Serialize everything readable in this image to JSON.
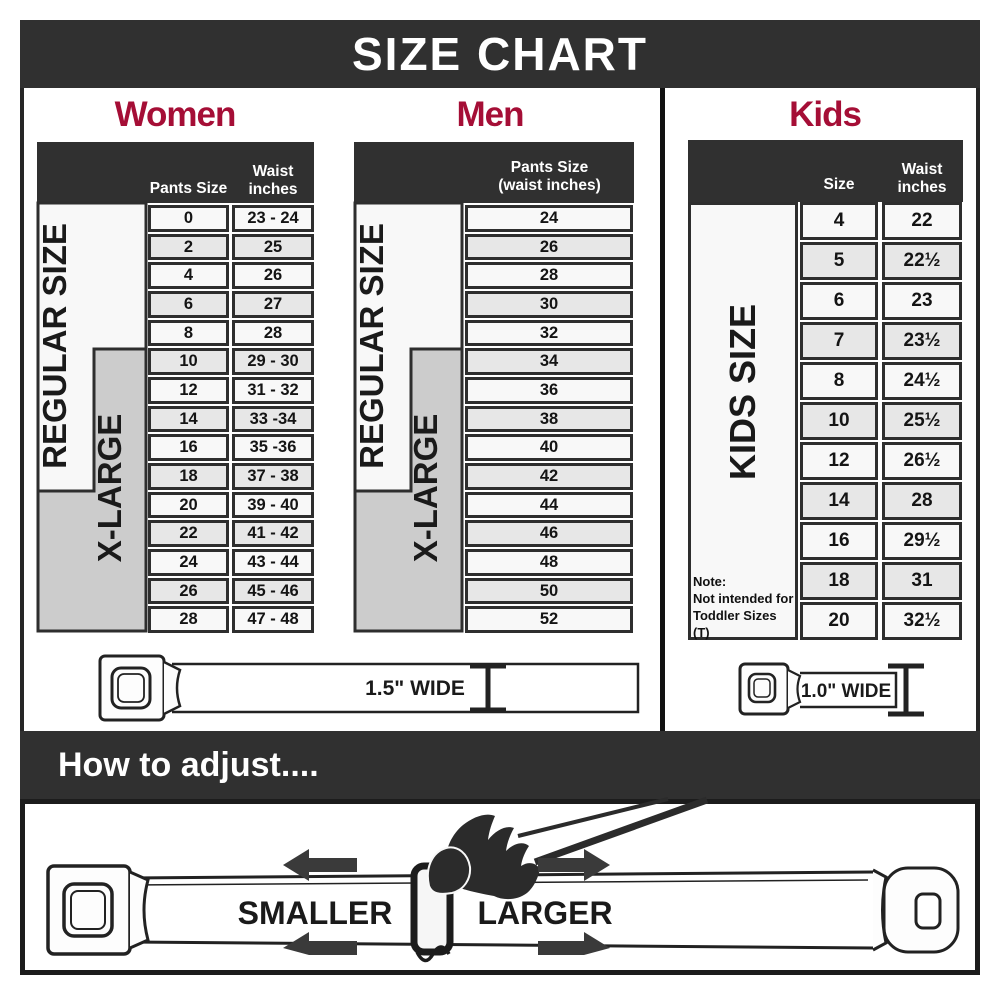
{
  "title": "SIZE CHART",
  "women": {
    "heading": "Women",
    "col1_header": "Pants Size",
    "col2_header_line1": "Waist",
    "col2_header_line2": "inches",
    "regular_label": "REGULAR SIZE",
    "xlarge_label": "X-LARGE",
    "rows": [
      [
        "0",
        "23 - 24"
      ],
      [
        "2",
        "25"
      ],
      [
        "4",
        "26"
      ],
      [
        "6",
        "27"
      ],
      [
        "8",
        "28"
      ],
      [
        "10",
        "29 - 30"
      ],
      [
        "12",
        "31 - 32"
      ],
      [
        "14",
        "33 -34"
      ],
      [
        "16",
        "35 -36"
      ],
      [
        "18",
        "37 - 38"
      ],
      [
        "20",
        "39 - 40"
      ],
      [
        "22",
        "41 - 42"
      ],
      [
        "24",
        "43 - 44"
      ],
      [
        "26",
        "45 - 46"
      ],
      [
        "28",
        "47 - 48"
      ]
    ],
    "belt_label": "1.5\" WIDE"
  },
  "men": {
    "heading": "Men",
    "header_line1": "Pants Size",
    "header_line2": "(waist inches)",
    "regular_label": "REGULAR SIZE",
    "xlarge_label": "X-LARGE",
    "sizes": [
      "24",
      "26",
      "28",
      "30",
      "32",
      "34",
      "36",
      "38",
      "40",
      "42",
      "44",
      "46",
      "48",
      "50",
      "52"
    ]
  },
  "kids": {
    "heading": "Kids",
    "size_header": "Size",
    "waist_header_line1": "Waist",
    "waist_header_line2": "inches",
    "kids_label": "KIDS SIZE",
    "rows": [
      [
        "4",
        "22"
      ],
      [
        "5",
        "22½"
      ],
      [
        "6",
        "23"
      ],
      [
        "7",
        "23½"
      ],
      [
        "8",
        "24½"
      ],
      [
        "10",
        "25½"
      ],
      [
        "12",
        "26½"
      ],
      [
        "14",
        "28"
      ],
      [
        "16",
        "29½"
      ],
      [
        "18",
        "31"
      ],
      [
        "20",
        "32½"
      ]
    ],
    "note": [
      "Note:",
      "Not intended for",
      "Toddler Sizes (T)"
    ],
    "belt_label": "1.0\" WIDE"
  },
  "how_to_adjust": {
    "heading": "How to adjust....",
    "smaller_label": "SMALLER",
    "larger_label": "LARGER"
  },
  "colors": {
    "band_dark": "#303030",
    "accent_red": "#A50E36",
    "row_light": "#f8f8f8",
    "row_alt": "#e7e7e7",
    "xlarge_gray": "#cccccc",
    "line": "#2e2e2e"
  }
}
